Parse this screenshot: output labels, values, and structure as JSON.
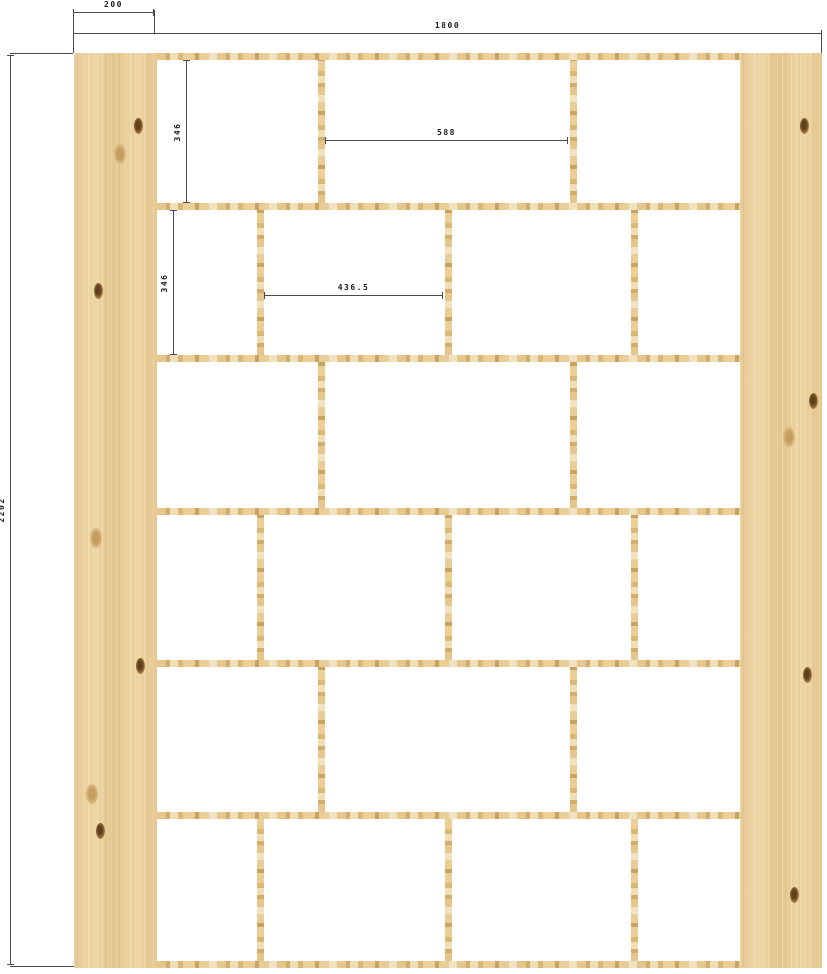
{
  "drawing": {
    "description": "furniture-shelf-unit-dimension-drawing",
    "dims": {
      "panel_width": "200",
      "total_width": "1800",
      "total_height": "2202",
      "row1_cell_height": "346",
      "row1_cell_width": "588",
      "row2_cell_height": "346",
      "row2_cell_width": "436.5"
    },
    "colors": {
      "wood_base": "#e9cf9e",
      "wood_light": "#f2e3c0",
      "wood_dark": "#c9a361",
      "knot": "#5f3f1d",
      "dim_line": "#4a4a4a",
      "background": "#ffffff"
    },
    "structure": {
      "shelf_y": [
        53,
        203,
        355,
        508,
        660,
        812,
        961
      ],
      "rows": [
        {
          "top": 60,
          "bottom": 203,
          "dividers": [
            318,
            570
          ]
        },
        {
          "top": 210,
          "bottom": 355,
          "dividers": [
            257,
            445,
            631
          ]
        },
        {
          "top": 362,
          "bottom": 508,
          "dividers": [
            318,
            570
          ]
        },
        {
          "top": 515,
          "bottom": 660,
          "dividers": [
            257,
            445,
            631
          ]
        },
        {
          "top": 667,
          "bottom": 812,
          "dividers": [
            318,
            570
          ]
        },
        {
          "top": 819,
          "bottom": 961,
          "dividers": [
            257,
            445,
            631
          ]
        }
      ],
      "left_panel_knots": [
        [
          78,
          8,
          "dark"
        ],
        [
          55,
          11,
          "soft"
        ],
        [
          30,
          26,
          "dark"
        ],
        [
          26,
          53,
          "soft"
        ],
        [
          80,
          67,
          "dark"
        ],
        [
          22,
          81,
          "soft"
        ],
        [
          32,
          85,
          "dark"
        ]
      ],
      "right_panel_knots": [
        [
          79,
          8,
          "dark"
        ],
        [
          90,
          38,
          "dark"
        ],
        [
          60,
          42,
          "soft"
        ],
        [
          82,
          68,
          "dark"
        ],
        [
          67,
          92,
          "dark"
        ]
      ]
    }
  }
}
